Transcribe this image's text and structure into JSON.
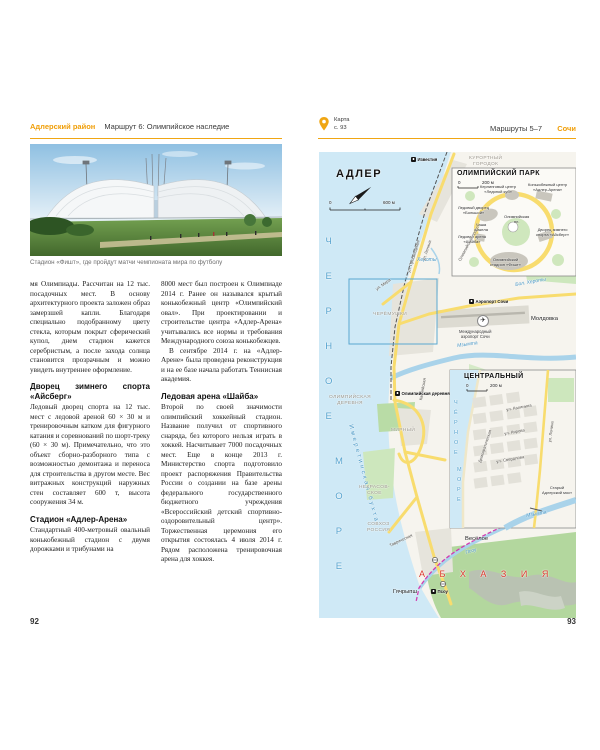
{
  "left_page": {
    "header": {
      "section": "Адлерский район",
      "title": "Маршрут 6: Олимпийское наследие"
    },
    "photo_caption": "Стадион «Фишт», где пройдут матчи чемпионата мира по футболу",
    "col1": {
      "para1": "мя Олимпиады. Рассчитан на 12 тыс. посадочных мест. В основу архитектурного проекта заложен образ замерзшей капли. Благодаря специально подобранному цвету стекла, которым покрыт сферический купол, днем стадион кажется серебристым, а после захода солнца становится прозрачным и можно увидеть внутреннее оформление.",
      "heading1": "Дворец зимнего спорта «Айсберг»",
      "para2": "Ледовый дворец спорта на 12 тыс. мест с ледовой ареной 60 × 30 м и тренировочным катком для фигурного катания и соревнований по шорт-треку (60 × 30 м). Примечательно, что это объект сборно-разборного типа с возможностью демонтажа и переноса для строительства в другом месте. Вес витражных конструкций наружных стен составляет 600 т, высота сооружения 34 м.",
      "heading2": "Стадион «Адлер-Арена»",
      "para3": "Стандартный 400-метровый овальный конькобежный стадион с двумя дорожками и трибунами на"
    },
    "col2": {
      "para1": "8000 мест был построен к Олимпиаде 2014 г. Ранее он назывался крытый конькобежный центр «Олимпийский овал». При проектировании и строительстве центра «Адлер-Арена» учитывались все нормы и требования Международного союза конькобежцев.",
      "para2": "В сентябре 2014 г. на «Адлер-Арене» была проведена реконструкция и на ее базе начала работать Теннисная академия.",
      "heading1": "Ледовая арена «Шайба»",
      "para3": "Второй по своей значимости олимпийский хоккейный стадион. Название получил от спортивного снаряда, без которого нельзя играть в хоккей. Насчитывает 7000 посадочных мест. Еще в конце 2013 г. Министерство спорта подготовило проект распоряжения Правительства России о создании на базе арены федерального государственного бюджетного учреждения «Всероссийский детский спортивно-оздоровительный центр». Торжественная церемония его открытия состоялась 4 июля 2014 г. Рядом расположена тренировочная арена для хоккея."
    },
    "page_number": "92"
  },
  "right_page": {
    "header": {
      "map_label": "Карта",
      "map_page": "с. 93",
      "routes": "Маршруты 5–7",
      "city": "Сочи"
    },
    "page_number": "93",
    "map": {
      "labels": [
        {
          "text": "АДЛЕР",
          "x": 17,
          "y": 16,
          "cls": "city-title",
          "name": "map-title-adler"
        },
        {
          "text": "0",
          "x": 10,
          "y": 48,
          "cls": "scale-txt"
        },
        {
          "text": "600 м",
          "x": 64,
          "y": 48,
          "cls": "scale-txt"
        },
        {
          "text": "Ч\nЕ\nР\nН\nО\nЕ",
          "x": 6,
          "y": 72,
          "cls": "sea-big",
          "name": "sea-label-chernoe"
        },
        {
          "text": "М\nО\nР\nЕ",
          "x": 16,
          "y": 292,
          "cls": "sea-big",
          "name": "sea-label-more"
        },
        {
          "text": "Имеретинская бухта",
          "x": 34,
          "y": 272,
          "cls": "bay",
          "rot": 75,
          "name": "bay-label"
        },
        {
          "text": "КУРОРТНЫЙ\nГОРОДОК",
          "x": 150,
          "y": 4,
          "cls": "district"
        },
        {
          "text": "ЧЕРЁМУШКИ",
          "x": 54,
          "y": 160,
          "cls": "district"
        },
        {
          "text": "ОЛИМПИЙСКАЯ\nДЕРЕВНЯ",
          "x": 10,
          "y": 243,
          "cls": "district"
        },
        {
          "text": "МИРНЫЙ",
          "x": 72,
          "y": 276,
          "cls": "district"
        },
        {
          "text": "НЕКРАСОВ-\nСКОЕ",
          "x": 40,
          "y": 333,
          "cls": "district"
        },
        {
          "text": "СОВХОЗ\nРОССИЯ",
          "x": 48,
          "y": 370,
          "cls": "district"
        },
        {
          "text": "Молдовка",
          "x": 212,
          "y": 164,
          "cls": "place"
        },
        {
          "text": "Весёлое",
          "x": 146,
          "y": 384,
          "cls": "place"
        },
        {
          "text": "Гячрыпш",
          "x": 74,
          "y": 437,
          "cls": "place"
        },
        {
          "text": "А Б Х А З И Я",
          "x": 100,
          "y": 417,
          "cls": "country",
          "name": "country-label-abkhazia"
        },
        {
          "text": "Мзымта",
          "x": 138,
          "y": 192,
          "cls": "water",
          "rot": -8
        },
        {
          "text": "Псоу",
          "x": 146,
          "y": 399,
          "cls": "water",
          "rot": -16
        },
        {
          "text": "Бол. Хероты",
          "x": 196,
          "y": 131,
          "cls": "water",
          "rot": -10
        },
        {
          "text": "Хероты",
          "x": 98,
          "y": 106,
          "cls": "water"
        },
        {
          "text": "ул. Ленина",
          "x": 103,
          "y": 108,
          "cls": "street",
          "rot": -72
        },
        {
          "text": "ул. Просвещения",
          "x": 88,
          "y": 120,
          "cls": "street",
          "rot": -73
        },
        {
          "text": "ул. Мира",
          "x": 56,
          "y": 136,
          "cls": "street",
          "rot": -35
        },
        {
          "text": "Каспийская",
          "x": 100,
          "y": 248,
          "cls": "street",
          "rot": -80
        },
        {
          "text": "Таврическая",
          "x": 70,
          "y": 392,
          "cls": "street",
          "rot": -25
        },
        {
          "text": "Международный\nаэропорт Сочи",
          "x": 140,
          "y": 178,
          "cls": "poi"
        },
        {
          "text": "✈",
          "x": 158,
          "y": 163,
          "cls": "plane",
          "name": "airport-icon"
        },
        {
          "text": "Известия",
          "x": 92,
          "y": 5,
          "cls": "station",
          "name": "station-izvestiya"
        },
        {
          "text": "Аэропорт Сочи",
          "x": 150,
          "y": 147,
          "cls": "station",
          "name": "station-aeroport-sochi"
        },
        {
          "text": "Олимпийская деревня",
          "x": 76,
          "y": 239,
          "cls": "station",
          "name": "station-olimpiyskaya-derevnya"
        },
        {
          "text": "Псоу",
          "x": 112,
          "y": 437,
          "cls": "station",
          "name": "station-psou"
        }
      ],
      "inset1": [
        {
          "text": "ОЛИМПИЙСКИЙ ПАРК",
          "x": 5,
          "y": 2,
          "cls": "inset-title",
          "name": "inset-title-olympic-park"
        },
        {
          "text": "0",
          "x": 6,
          "y": 12,
          "cls": "scale-txt"
        },
        {
          "text": "200 м",
          "x": 30,
          "y": 12,
          "cls": "scale-txt"
        },
        {
          "text": "Керлинговый центр\n«Ледяной куб»",
          "x": 28,
          "y": 17,
          "cls": "tiny"
        },
        {
          "text": "Конькобежный центр\n«Адлер-Арена»",
          "x": 76,
          "y": 15,
          "cls": "tiny"
        },
        {
          "text": "Ледовый дворец\n«Большой»",
          "x": 6,
          "y": 38,
          "cls": "tiny"
        },
        {
          "text": "Чаша\nфакела",
          "x": 22,
          "y": 55,
          "cls": "tiny"
        },
        {
          "text": "Ледовая арена\n«Шайба»",
          "x": 6,
          "y": 67,
          "cls": "tiny"
        },
        {
          "text": "Олимпийская\nпл.",
          "x": 52,
          "y": 47,
          "cls": "tiny"
        },
        {
          "text": "Дворец зимнего\nспорта «Айсберг»",
          "x": 84,
          "y": 60,
          "cls": "tiny"
        },
        {
          "text": "Олимпийский\nстадион «Фишт»",
          "x": 38,
          "y": 90,
          "cls": "tiny"
        },
        {
          "text": "Олимпийский просп.",
          "x": 6,
          "y": 92,
          "cls": "street",
          "rot": -62
        }
      ],
      "inset2": [
        {
          "text": "ЦЕНТРАЛЬНЫЙ",
          "x": 14,
          "y": 3,
          "cls": "inset-title",
          "name": "inset-title-centralny"
        },
        {
          "text": "0",
          "x": 16,
          "y": 13,
          "cls": "scale-txt"
        },
        {
          "text": "200 м",
          "x": 40,
          "y": 13,
          "cls": "scale-txt"
        },
        {
          "text": "Ч\nЁ\nР\nН\nО\nЕ",
          "x": 4,
          "y": 28,
          "cls": "sea-small"
        },
        {
          "text": "М\nО\nР\nЕ",
          "x": 7,
          "y": 95,
          "cls": "sea-small"
        },
        {
          "text": "ул. Ленина",
          "x": 98,
          "y": 72,
          "cls": "street",
          "rot": -83
        },
        {
          "text": "Демократическая",
          "x": 28,
          "y": 92,
          "cls": "street",
          "rot": -72
        },
        {
          "text": "ул. Калинина",
          "x": 56,
          "y": 38,
          "cls": "street",
          "rot": -10
        },
        {
          "text": "ул. Кирова",
          "x": 54,
          "y": 62,
          "cls": "street",
          "rot": -10
        },
        {
          "text": "ул. Свердлова",
          "x": 46,
          "y": 90,
          "cls": "street",
          "rot": -10
        },
        {
          "text": "Старый\nАдлерский мост",
          "x": 92,
          "y": 116,
          "cls": "tiny"
        },
        {
          "text": "Мзымта",
          "x": 76,
          "y": 144,
          "cls": "water",
          "rot": -10
        }
      ]
    }
  }
}
